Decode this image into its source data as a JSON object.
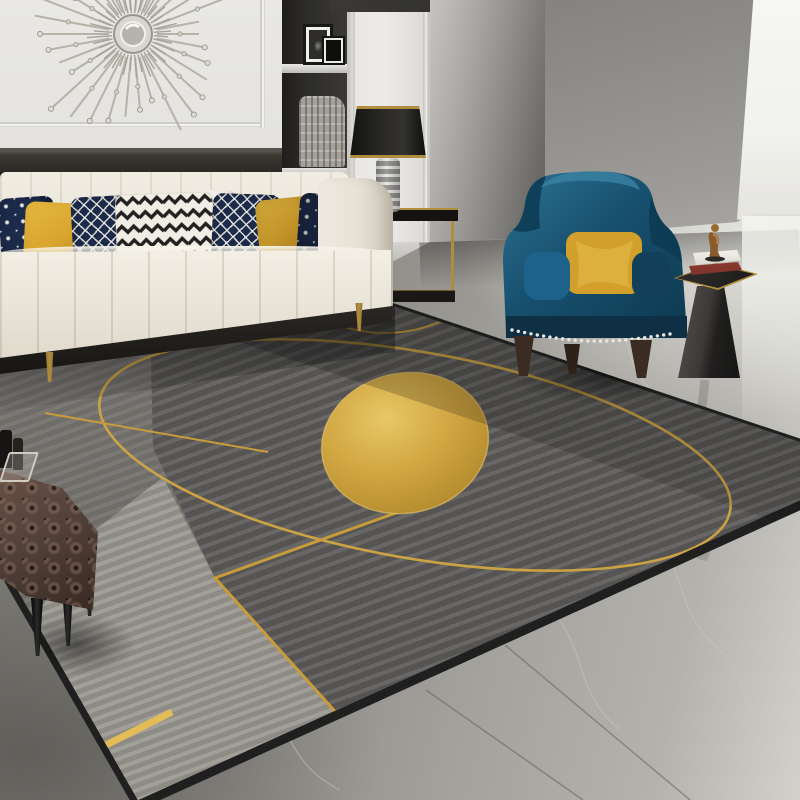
{
  "image_description": "Product photo of a modern living room showing a large grey geometric area rug with gold circle outlines, a solid gold oval, gold accent lines and striped grey sections; cream leather sofa with navy, white-and-black patterned and mustard pillows; silver sunburst mirror on white panelled wall; recessed shelf niche with picture frames and a basket; black-shade table lamp on a gold side table; teal-blue velvet wingback chair with mustard pillow and nailhead trim; dark pedestal side table with books and a bronze figurine; brown tufted leather ottoman with a drinks tray; grey marble floor with a bright window light on the right",
  "objects": [
    "sunburst-mirror",
    "panelled-wall",
    "shelf-niche",
    "picture-frames",
    "woven-basket",
    "table-lamp",
    "gold-console-table",
    "cream-sofa",
    "throw-pillows",
    "area-rug",
    "gold-oval-motif",
    "gold-circle-outlines",
    "blue-wingback-chair",
    "yellow-pillow",
    "pedestal-side-table",
    "books",
    "bronze-figurine",
    "tufted-ottoman",
    "drinks-tray",
    "marble-floor"
  ],
  "colors": {
    "wall-white": "#e9e8e4",
    "wainscot": "#2e2a26",
    "niche-bg": "#2e2d2a",
    "basket": "#b3afa7",
    "gray-wall": "#9d9b97",
    "window-light": "#f6f6f2",
    "floor-mid": "#a3a19c",
    "rug-dark": "#555351",
    "rug-medium": "#6f6c67",
    "rug-light-a": "#a09d96",
    "rug-light-b": "#8a8780",
    "rug-gold": "#c9992e",
    "rug-gold-bright": "#e8bc4e",
    "rug-border": "#161616",
    "sofa-cream": "#e9e4d8",
    "sofa-rail": "#171513",
    "leg-gold": "#b08d3e",
    "pillow-navy": "#1c2b4a",
    "pillow-white": "#f0ede5",
    "pillow-mustard": "#d9a62e",
    "chair-blue": "#17506e",
    "chair-blue-light": "#2d7394",
    "chair-blue-dark": "#0d3950",
    "chair-pillow-yellow": "#d2a02a",
    "chair-wood": "#3a2c22",
    "table-gold": "#b08d3e",
    "book-red": "#7e332b",
    "figurine-bronze": "#9a6a35",
    "ottoman-brown": "#52403a",
    "lamp-shade": "#34332f",
    "lamp-gold": "#b08d3e",
    "sunburst-metal": "#b6b2a8"
  },
  "sunburst": {
    "center_x": 113,
    "center_y": 114,
    "ray_count": 34,
    "inner_ray_count": 40
  },
  "chair": {
    "nailhead_count": 26
  }
}
